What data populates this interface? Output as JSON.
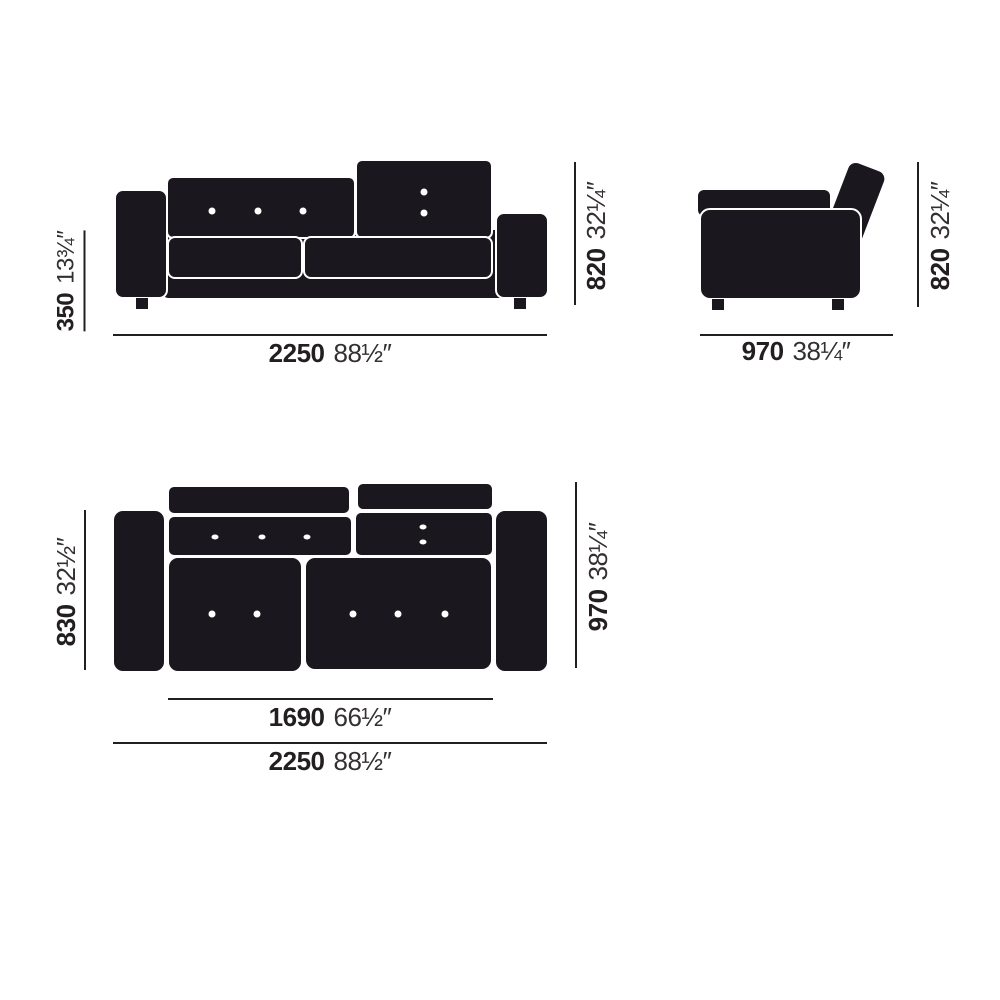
{
  "diagram": {
    "subject": "sofa-dimension-drawing",
    "colors": {
      "ink": "#231f20",
      "shape_fill": "#1b171e",
      "outline": "#ffffff",
      "background": "#ffffff"
    },
    "views": {
      "front": {
        "seat_height": {
          "mm": "350",
          "in": "13¾″"
        },
        "height": {
          "mm": "820",
          "in": "32¼″"
        },
        "width": {
          "mm": "2250",
          "in": "88½″"
        }
      },
      "side": {
        "height": {
          "mm": "820",
          "in": "32¼″"
        },
        "depth": {
          "mm": "970",
          "in": "38¼″"
        }
      },
      "top": {
        "inner_depth": {
          "mm": "830",
          "in": "32½″"
        },
        "depth": {
          "mm": "970",
          "in": "38¼″"
        },
        "seat_width": {
          "mm": "1690",
          "in": "66½″"
        },
        "width": {
          "mm": "2250",
          "in": "88½″"
        }
      }
    }
  }
}
